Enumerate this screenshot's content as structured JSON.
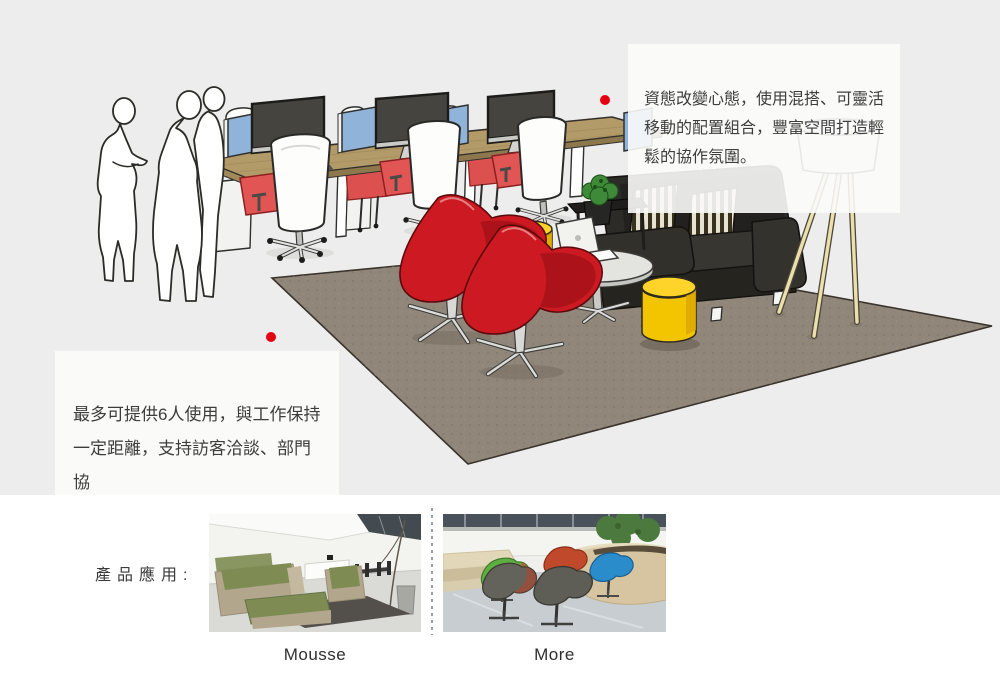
{
  "callouts": {
    "top_right": {
      "text": "資態改變心態，使用混搭、可靈活\n移動的配置組合，豐富空間打造輕\n鬆的協作氛圍。"
    },
    "left": {
      "text": "最多可提供6人使用，與工作保持\n一定距離，支持訪客洽談、部門協\n作等辦公活動。"
    }
  },
  "products": {
    "section_label": "產品應用:",
    "items": [
      {
        "name": "Mousse"
      },
      {
        "name": "More"
      }
    ]
  },
  "illustration": {
    "alt": "Sketch-style open office scene: bench desks with monitors and task chairs, two standing figure silhouettes, two red swivel lounge chairs, yellow ottomans, white oval table with laptop, black sofa with striped pillows and tripod floor lamp on a taupe rug"
  },
  "palette": {
    "hero_background": "#ededee",
    "section_background": "#ffffff",
    "callout_background": "#fafafa",
    "text": "#3d3d3d",
    "dot_red": "#e50012",
    "lounge_chair_red": "#cd1a22",
    "ottoman_yellow": "#f3c400",
    "sofa_black": "#2d2b27",
    "rug_taupe": "#90867a",
    "desk_wood": "#b39b69",
    "monitor_blue": "#8fb3d9",
    "task_seat_red": "#e15555",
    "lamp_leg_cream": "#ecdfae"
  }
}
